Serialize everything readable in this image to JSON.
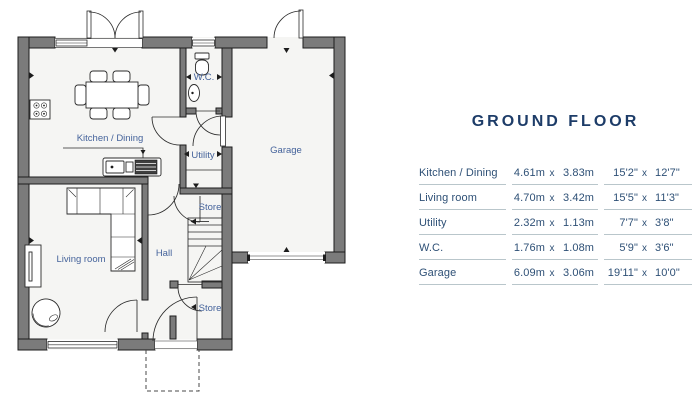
{
  "colors": {
    "title": "#1d3c68",
    "tabletext": "#2e5076",
    "rule": "#b9c6cb",
    "label": "#45639b",
    "wall": "#7b7b7b",
    "outline": "#1c1c1c",
    "floor": "#f5f5f3"
  },
  "panel": {
    "title": "GROUND FLOOR"
  },
  "table": {
    "separator": "x",
    "rows": [
      {
        "room": "Kitchen / Dining",
        "m1": "4.61m",
        "m2": "3.83m",
        "f1": "15'2\"",
        "f2": "12'7\""
      },
      {
        "room": "Living room",
        "m1": "4.70m",
        "m2": "3.42m",
        "f1": "15'5\"",
        "f2": "11'3\""
      },
      {
        "room": "Utility",
        "m1": "2.32m",
        "m2": "1.13m",
        "f1": "7'7\"",
        "f2": "3'8\""
      },
      {
        "room": "W.C.",
        "m1": "1.76m",
        "m2": "1.08m",
        "f1": "5'9\"",
        "f2": "3'6\""
      },
      {
        "room": "Garage",
        "m1": "6.09m",
        "m2": "3.06m",
        "f1": "19'11\"",
        "f2": "10'0\""
      }
    ]
  },
  "plan": {
    "labels": [
      {
        "id": "kitchen-dining",
        "text": "Kitchen / Dining",
        "x": 110,
        "y": 141
      },
      {
        "id": "living-room",
        "text": "Living room",
        "x": 81,
        "y": 262
      },
      {
        "id": "hall",
        "text": "Hall",
        "x": 164,
        "y": 256
      },
      {
        "id": "utility",
        "text": "Utility",
        "x": 203,
        "y": 158
      },
      {
        "id": "wc",
        "text": "W.C.",
        "x": 204,
        "y": 80
      },
      {
        "id": "garage",
        "text": "Garage",
        "x": 286,
        "y": 153
      },
      {
        "id": "store-upper",
        "text": "Store",
        "x": 210,
        "y": 210
      },
      {
        "id": "store-lower",
        "text": "Store",
        "x": 210,
        "y": 311
      }
    ]
  }
}
